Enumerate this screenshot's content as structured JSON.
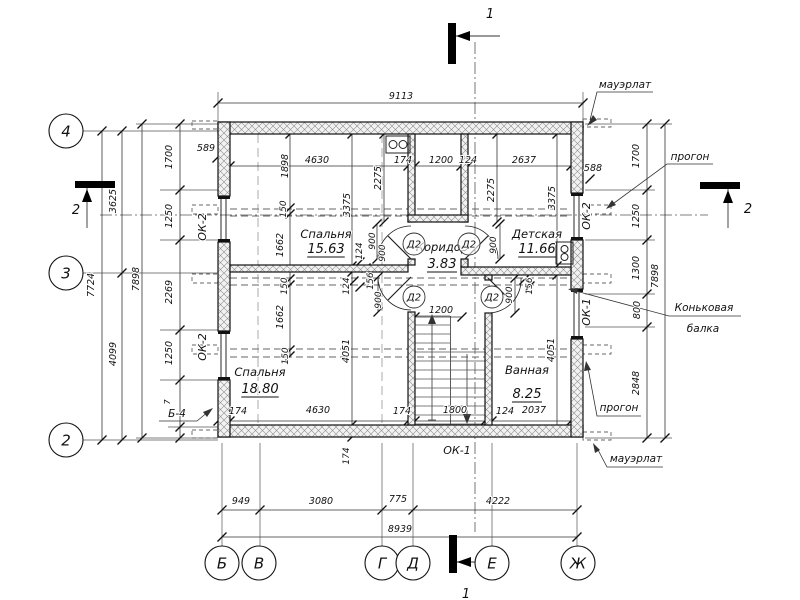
{
  "drawing": {
    "rooms": [
      {
        "name": "Спальня",
        "area": "15.63",
        "x": 326,
        "y": 238,
        "ay": 253
      },
      {
        "name": "Детская",
        "area": "11.66",
        "x": 537,
        "y": 238,
        "ay": 253
      },
      {
        "name": "Коридор",
        "area": "3.83",
        "x": 442,
        "y": 251,
        "ay": 268
      },
      {
        "name": "Спальня",
        "area": "18.80",
        "x": 260,
        "y": 376,
        "ay": 393
      },
      {
        "name": "Ванная",
        "area": "8.25",
        "x": 527,
        "y": 374,
        "ay": 398
      }
    ],
    "axes": {
      "left": [
        {
          "t": "4",
          "x": 66,
          "y": 131
        },
        {
          "t": "3",
          "x": 66,
          "y": 273
        },
        {
          "t": "2",
          "x": 66,
          "y": 440
        }
      ],
      "bottom": [
        {
          "t": "Б",
          "x": 222,
          "y": 563
        },
        {
          "t": "В",
          "x": 259,
          "y": 563
        },
        {
          "t": "Г",
          "x": 382,
          "y": 563
        },
        {
          "t": "Д",
          "x": 413,
          "y": 563
        },
        {
          "t": "Е",
          "x": 492,
          "y": 563
        },
        {
          "t": "Ж",
          "x": 578,
          "y": 563
        }
      ]
    },
    "door_tags": {
      "label": "Д2",
      "positions": [
        [
          414,
          244
        ],
        [
          469,
          244
        ],
        [
          414,
          297
        ],
        [
          492,
          297
        ]
      ]
    },
    "labels": {
      "dimensions": [
        {
          "t": "9113",
          "x": 401,
          "y": 99
        },
        {
          "t": "589",
          "x": 206,
          "y": 151
        },
        {
          "t": "588",
          "x": 593,
          "y": 171
        },
        {
          "t": "4630",
          "x": 317,
          "y": 163
        },
        {
          "t": "174",
          "x": 403,
          "y": 163
        },
        {
          "t": "1200",
          "x": 441,
          "y": 163
        },
        {
          "t": "124",
          "x": 468,
          "y": 163
        },
        {
          "t": "2637",
          "x": 524,
          "y": 163
        },
        {
          "t": "1200",
          "x": 441,
          "y": 313
        },
        {
          "t": "174",
          "x": 238,
          "y": 414
        },
        {
          "t": "4630",
          "x": 318,
          "y": 413
        },
        {
          "t": "174",
          "x": 402,
          "y": 414
        },
        {
          "t": "1800",
          "x": 455,
          "y": 413
        },
        {
          "t": "124",
          "x": 505,
          "y": 414
        },
        {
          "t": "2037",
          "x": 534,
          "y": 413
        },
        {
          "t": "949",
          "x": 241,
          "y": 504
        },
        {
          "t": "3080",
          "x": 321,
          "y": 504
        },
        {
          "t": "775",
          "x": 398,
          "y": 502
        },
        {
          "t": "4222",
          "x": 498,
          "y": 504
        },
        {
          "t": "8939",
          "x": 400,
          "y": 532
        },
        {
          "t": "7724",
          "x": 94,
          "y": 285,
          "r": -90
        },
        {
          "t": "3625",
          "x": 116,
          "y": 201,
          "r": -90
        },
        {
          "t": "4099",
          "x": 116,
          "y": 354,
          "r": -90
        },
        {
          "t": "7898",
          "x": 139,
          "y": 279,
          "r": -90
        },
        {
          "t": "1700",
          "x": 172,
          "y": 157,
          "r": -90
        },
        {
          "t": "1250",
          "x": 172,
          "y": 216,
          "r": -90
        },
        {
          "t": "2269",
          "x": 172,
          "y": 292,
          "r": -90
        },
        {
          "t": "1250",
          "x": 172,
          "y": 353,
          "r": -90
        },
        {
          "t": "7",
          "x": 170,
          "y": 402,
          "r": -90,
          "s": 8
        },
        {
          "t": "1700",
          "x": 639,
          "y": 156,
          "r": -90
        },
        {
          "t": "1250",
          "x": 639,
          "y": 216,
          "r": -90
        },
        {
          "t": "1300",
          "x": 639,
          "y": 268,
          "r": -90
        },
        {
          "t": "800",
          "x": 640,
          "y": 310,
          "r": -90
        },
        {
          "t": "2848",
          "x": 639,
          "y": 383,
          "r": -90
        },
        {
          "t": "7898",
          "x": 658,
          "y": 276,
          "r": -90
        },
        {
          "t": "1898",
          "x": 288,
          "y": 166,
          "r": -90
        },
        {
          "t": "2275",
          "x": 381,
          "y": 178,
          "r": -90
        },
        {
          "t": "3375",
          "x": 350,
          "y": 205,
          "r": -90
        },
        {
          "t": "2275",
          "x": 494,
          "y": 190,
          "r": -90
        },
        {
          "t": "3375",
          "x": 555,
          "y": 198,
          "r": -90
        },
        {
          "t": "150",
          "x": 286,
          "y": 209,
          "r": -90,
          "s": 9
        },
        {
          "t": "1662",
          "x": 283,
          "y": 245,
          "r": -90
        },
        {
          "t": "150",
          "x": 287,
          "y": 286,
          "r": -90,
          "s": 9
        },
        {
          "t": "1662",
          "x": 283,
          "y": 317,
          "r": -90
        },
        {
          "t": "150",
          "x": 288,
          "y": 356,
          "r": -90,
          "s": 9
        },
        {
          "t": "124",
          "x": 362,
          "y": 251,
          "r": -90,
          "s": 9
        },
        {
          "t": "124",
          "x": 349,
          "y": 286,
          "r": -90,
          "s": 9
        },
        {
          "t": "900",
          "x": 375,
          "y": 241,
          "r": -90,
          "s": 9
        },
        {
          "t": "900",
          "x": 385,
          "y": 253,
          "r": -90,
          "s": 9
        },
        {
          "t": "156",
          "x": 373,
          "y": 281,
          "r": -90,
          "s": 9
        },
        {
          "t": "900",
          "x": 381,
          "y": 300,
          "r": -90,
          "s": 9
        },
        {
          "t": "900",
          "x": 496,
          "y": 245,
          "r": -90,
          "s": 9
        },
        {
          "t": "156",
          "x": 532,
          "y": 286,
          "r": -90,
          "s": 9
        },
        {
          "t": "900",
          "x": 512,
          "y": 295,
          "r": -90,
          "s": 9
        },
        {
          "t": "4051",
          "x": 349,
          "y": 351,
          "r": -90
        },
        {
          "t": "4051",
          "x": 554,
          "y": 350,
          "r": -90
        },
        {
          "t": "174",
          "x": 349,
          "y": 456,
          "r": -90,
          "s": 9
        }
      ],
      "windows": [
        {
          "t": "ОК-2",
          "x": 206,
          "y": 227,
          "r": -90,
          "s": 11
        },
        {
          "t": "ОК-2",
          "x": 206,
          "y": 347,
          "r": -90,
          "s": 11
        },
        {
          "t": "ОК-2",
          "x": 590,
          "y": 216,
          "r": -90,
          "s": 11
        },
        {
          "t": "ОК-1",
          "x": 590,
          "y": 312,
          "r": -90,
          "s": 11
        },
        {
          "t": "ОК-1",
          "x": 457,
          "y": 454,
          "s": 11
        }
      ],
      "callouts": [
        {
          "t": "мауэрлат",
          "x": 625,
          "y": 88,
          "s": 10.5
        },
        {
          "t": "прогон",
          "x": 690,
          "y": 160,
          "s": 10.5
        },
        {
          "t": "Коньковая",
          "x": 704,
          "y": 311,
          "s": 10.5
        },
        {
          "t": "балка",
          "x": 703,
          "y": 332,
          "s": 10.5
        },
        {
          "t": "прогон",
          "x": 619,
          "y": 411,
          "s": 10.5
        },
        {
          "t": "мауэрлат",
          "x": 636,
          "y": 462,
          "s": 10.5
        },
        {
          "t": "Б-4",
          "x": 177,
          "y": 417,
          "s": 10.5
        }
      ],
      "sections": [
        {
          "t": "1",
          "x": 490,
          "y": 18,
          "s": 13
        },
        {
          "t": "1",
          "x": 466,
          "y": 598,
          "s": 13
        },
        {
          "t": "2",
          "x": 76,
          "y": 214,
          "s": 13
        },
        {
          "t": "2",
          "x": 748,
          "y": 213,
          "s": 13
        }
      ]
    }
  }
}
